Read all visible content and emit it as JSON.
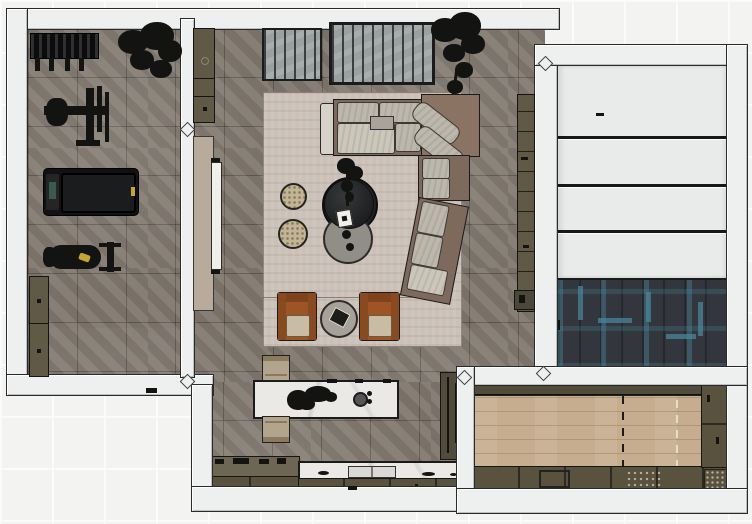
{
  "scene": {
    "title": "Top-down interior floor plan render",
    "view": "plan (bird's-eye) of an L-shaped residence with attached garage",
    "rooms": [
      {
        "id": "gym",
        "name": "home-gym",
        "floor": "gray stone tile",
        "furniture": [
          "dumbbell-rack",
          "potted-tree",
          "strength-machine",
          "treadmill",
          "weight-bench",
          "storage-cabinet"
        ]
      },
      {
        "id": "living-room",
        "name": "living-room",
        "floor": "gray stone tile with large area rug",
        "furniture": [
          "slatted-console-left",
          "slatted-console-right",
          "tall-plant",
          "sectional-sofa",
          "corner-chaise",
          "dark-round-coffee-table",
          "gray-round-coffee-table",
          "table-plant",
          "white-book",
          "pouf",
          "pouf",
          "leather-armchair",
          "leather-armchair",
          "round-side-table",
          "wall-shelf-unit",
          "wall-cabinet",
          "sliding-door-panel"
        ]
      },
      {
        "id": "kitchen",
        "name": "kitchen",
        "floor": "gray stone tile",
        "furniture": [
          "marble-island",
          "island-chair",
          "island-chair",
          "cooktop-counter",
          "sink-counter",
          "tall-cabinet"
        ]
      },
      {
        "id": "garage",
        "name": "garage",
        "floor": "dark herringbone tile with teal accents",
        "furniture": [
          "garage-door-4-panels"
        ]
      },
      {
        "id": "mudroom",
        "name": "mudroom-pantry",
        "floor": "oak plank",
        "furniture": [
          "upper-cabinet-strip",
          "base-cabinet-row",
          "side-cabinet-column"
        ]
      }
    ],
    "counts": {
      "garage_door_panels": 4,
      "island_seats": 2,
      "armchairs": 2,
      "poufs": 2
    }
  },
  "palette": {
    "bg_tile": "#f3f3f1",
    "grout": "#fbfbfa",
    "wall_fill": "#eef0f0",
    "wall_line": "#2a2a28",
    "floor_base": "#81786e",
    "rug": "#cbc1b8",
    "sofa_frame": "#7d6a5c",
    "sofa_chaise": "#8a7362",
    "cushion_light": "#bdb8ac",
    "cushion_pale": "#ccc7bb",
    "rust": "#9e5526",
    "seat_beige": "#c9bca4",
    "olive": "#5f5946",
    "olive_dark": "#514b3c",
    "marble": "#eae9e5",
    "near_black": "#131311",
    "wood": "#c6ad8f",
    "herring_base": "#33373d",
    "herring_teal": "#48869c",
    "garage_panel": "#e9ebea",
    "door_panel_beige": "#b8ab9c",
    "table_dark": "#28292a",
    "table_gray": "#918e87",
    "pouf_beige": "#c2b494",
    "slat_gray": "#9ba1a0",
    "chair_tan": "#b3a48e",
    "screen_teal": "#3a5a50",
    "accent_yellow": "#c7a42e",
    "white_obj": "#f1efe9"
  }
}
